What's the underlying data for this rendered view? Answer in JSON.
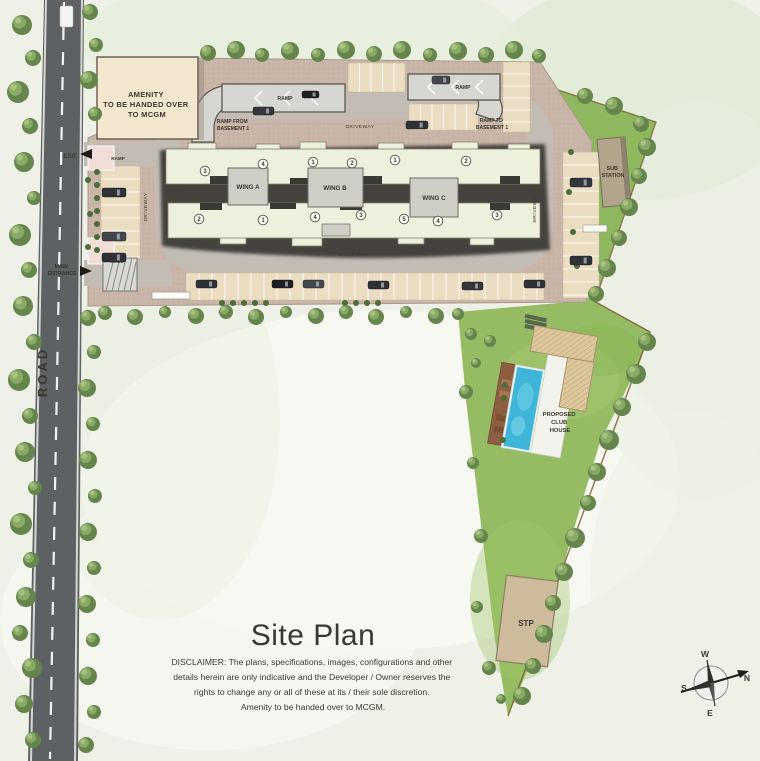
{
  "title": "Site Plan",
  "disclaimer": {
    "lines": [
      "DISCLAIMER: The plans, specifications, images, configurations and other",
      "details herein are only indicative and the Developer / Owner reserves the",
      "rights to change any or all of these at its / their sole discretion.",
      "Amenity to be handed over to MCGM."
    ]
  },
  "road": {
    "label": "ROAD"
  },
  "amenity": {
    "lines": [
      "AMENITY",
      "TO BE HANDED OVER",
      "TO MCGM"
    ]
  },
  "wings": [
    {
      "name": "WING A"
    },
    {
      "name": "WING B"
    },
    {
      "name": "WING C"
    }
  ],
  "unit_markers": [
    {
      "n": "3",
      "x": 205,
      "y": 171
    },
    {
      "n": "4",
      "x": 263,
      "y": 164
    },
    {
      "n": "1",
      "x": 313,
      "y": 162
    },
    {
      "n": "2",
      "x": 352,
      "y": 163
    },
    {
      "n": "1",
      "x": 395,
      "y": 160
    },
    {
      "n": "2",
      "x": 466,
      "y": 161
    },
    {
      "n": "2",
      "x": 199,
      "y": 219
    },
    {
      "n": "1",
      "x": 263,
      "y": 220
    },
    {
      "n": "4",
      "x": 315,
      "y": 217
    },
    {
      "n": "3",
      "x": 361,
      "y": 215
    },
    {
      "n": "5",
      "x": 404,
      "y": 219
    },
    {
      "n": "4",
      "x": 438,
      "y": 221
    },
    {
      "n": "3",
      "x": 497,
      "y": 215
    }
  ],
  "labels": {
    "exit": "EXIT",
    "main_entrance": {
      "lines": [
        "MAIN",
        "ENTRANCE"
      ]
    },
    "ramp": "RAMP",
    "ramp_from_basement": {
      "lines": [
        "RAMP FROM",
        "BASEMENT 1"
      ]
    },
    "ramp_to_basement": {
      "lines": [
        "RAMP TO",
        "BASEMENT 1"
      ]
    },
    "driveway": "DRIVEWAY",
    "sub_station": {
      "lines": [
        "SUB",
        "STATION"
      ]
    },
    "club_house": {
      "lines": [
        "PROPOSED",
        "CLUB",
        "HOUSE"
      ]
    },
    "stp": "STP"
  },
  "compass": {
    "n": "N",
    "s": "S",
    "e": "E",
    "w": "W"
  },
  "colors": {
    "road": "#5d6164",
    "paving": "#c9b5a8",
    "driveway_ring": "#c3bcb4",
    "lawn": "#95bc62",
    "green_strip": "#8fb85e",
    "building": "#ecf0dc",
    "building_shadow": "#3b3934",
    "amenity_block": "#f4e7cf",
    "parking_stall": "#eaddc1",
    "ramp": "#d6d6d2",
    "pool": "#3eb5d9",
    "pool_deck": "#8d5f42",
    "club_roof": "#ddc79d",
    "stp_block": "#cdbb9c",
    "sub_station_block": "#b3a58c",
    "title_gray": "#9a9a9a",
    "boundary_brown": "#7a5a35"
  }
}
